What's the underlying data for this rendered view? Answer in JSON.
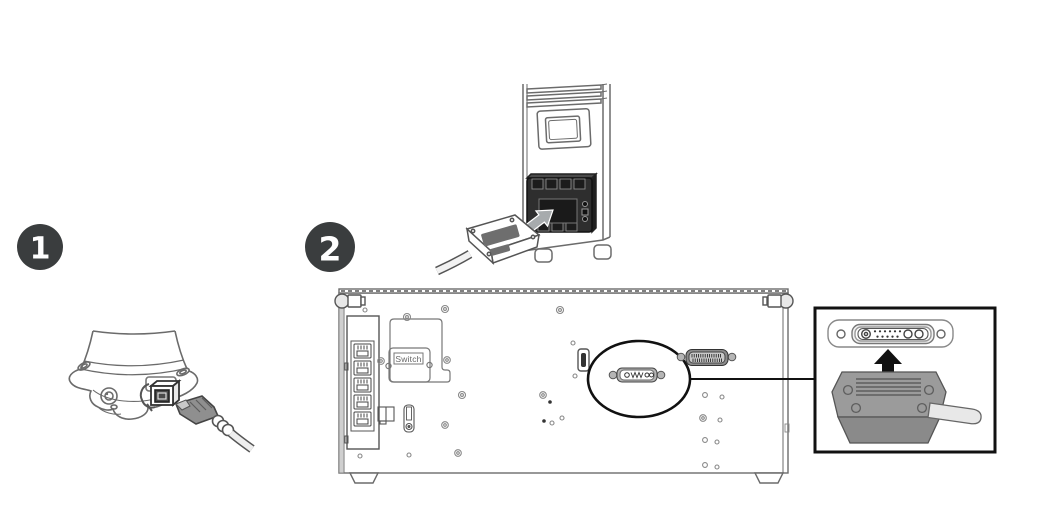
{
  "steps": [
    {
      "number": "1"
    },
    {
      "number": "2"
    }
  ],
  "back_panel": {
    "switch_label": "Switch",
    "ethernet_port_count": 5
  },
  "icons": {
    "tower_insert_arrow": "arrow-up-right",
    "callout_insert_arrow": "arrow-up"
  },
  "colors": {
    "badge_fill": "#3a3d3e",
    "badge_text": "#ffffff",
    "outline": "#6b6b6b",
    "dark_connector": "#2e2e2e",
    "connector_housing": "#9b9b9b",
    "callout_border": "#111111",
    "cable": "#e8e8e8"
  }
}
